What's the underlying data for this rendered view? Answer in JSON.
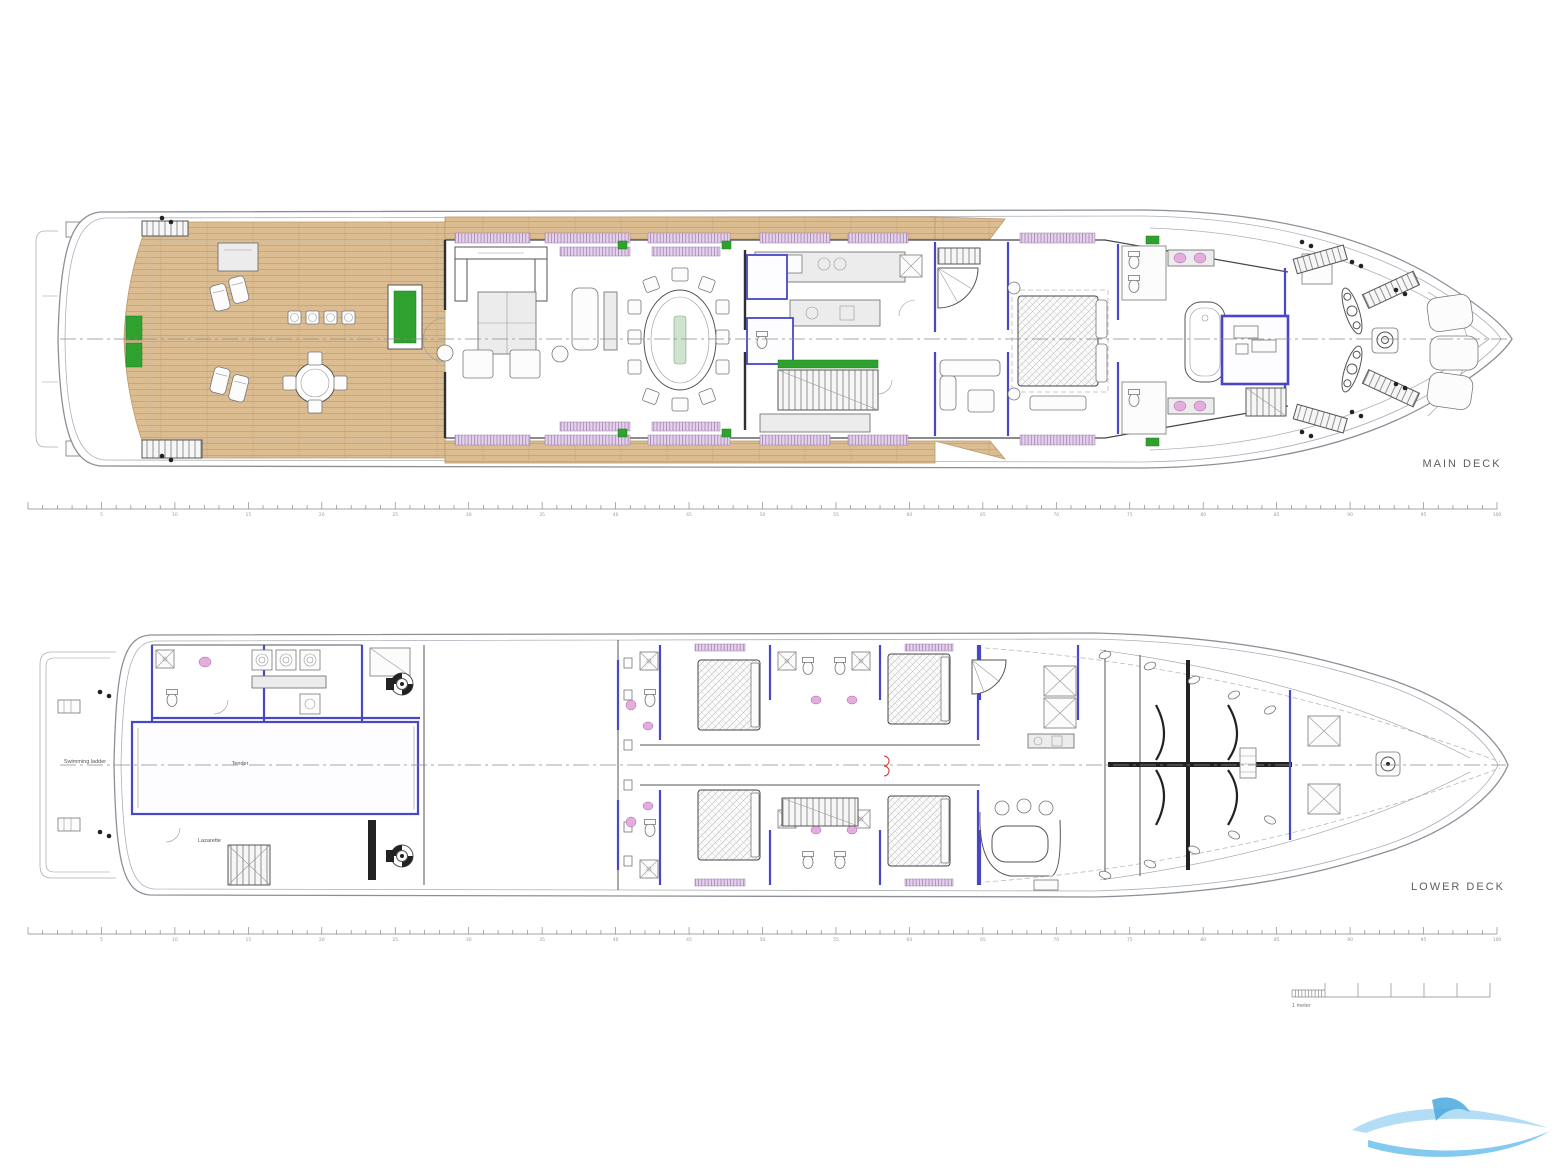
{
  "page": {
    "background": "#ffffff"
  },
  "main_deck": {
    "label": "MAIN DECK"
  },
  "lower_deck": {
    "label": "LOWER DECK",
    "swimming_ladder_label": "Swimming ladder",
    "tender_label": "Tender",
    "lazarette_label": "Lazarette"
  },
  "scale_bar": {
    "label": "1 meter"
  },
  "rulers": {
    "minor_per_major": 5,
    "numbers": [
      "5",
      "10",
      "15",
      "20",
      "25",
      "30",
      "35",
      "40",
      "45",
      "50",
      "55",
      "60",
      "65",
      "70",
      "75",
      "80",
      "85",
      "90",
      "95",
      "100"
    ]
  },
  "colors": {
    "blue": "#4747c8",
    "green": "#2fa12f",
    "pink": "#e3aedd",
    "teak": "#dcbd92",
    "teak_line": "#c6a06e",
    "window_bg": "#e3d3ea",
    "window_line": "#a77fb5",
    "wm_light": "#9fd4f2",
    "wm_mid": "#6fc0ec",
    "wm_dark": "#49a8dd"
  }
}
